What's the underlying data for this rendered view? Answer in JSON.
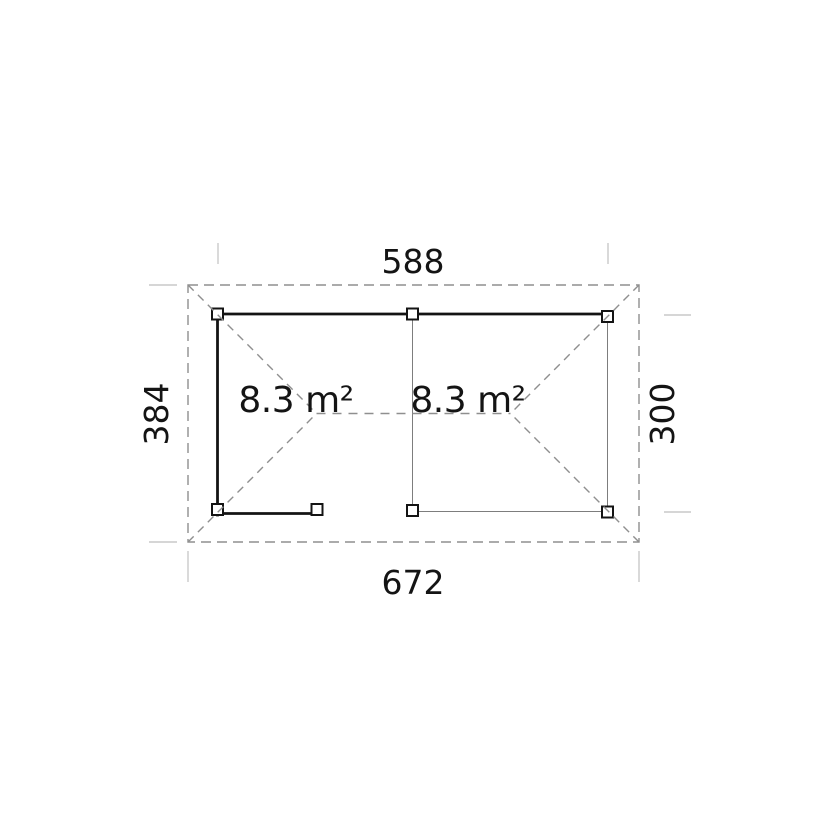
{
  "canvas": {
    "width": "828",
    "height": "828",
    "background": "#ffffff"
  },
  "plan": {
    "type": "floor-plan",
    "dimensions": {
      "top_width": "588",
      "bottom_width": "672",
      "left_depth": "384",
      "right_depth": "300"
    },
    "rooms": [
      {
        "id": "left-room",
        "area_label": "8.3 m²"
      },
      {
        "id": "right-room",
        "area_label": "8.3 m²"
      }
    ],
    "colors": {
      "wall": "#141414",
      "roof_dash": "#8f8f8f",
      "thin_line": "#7d7d7d",
      "tick": "#c9c9c9",
      "text": "#141414",
      "post_fill": "#ffffff"
    }
  }
}
